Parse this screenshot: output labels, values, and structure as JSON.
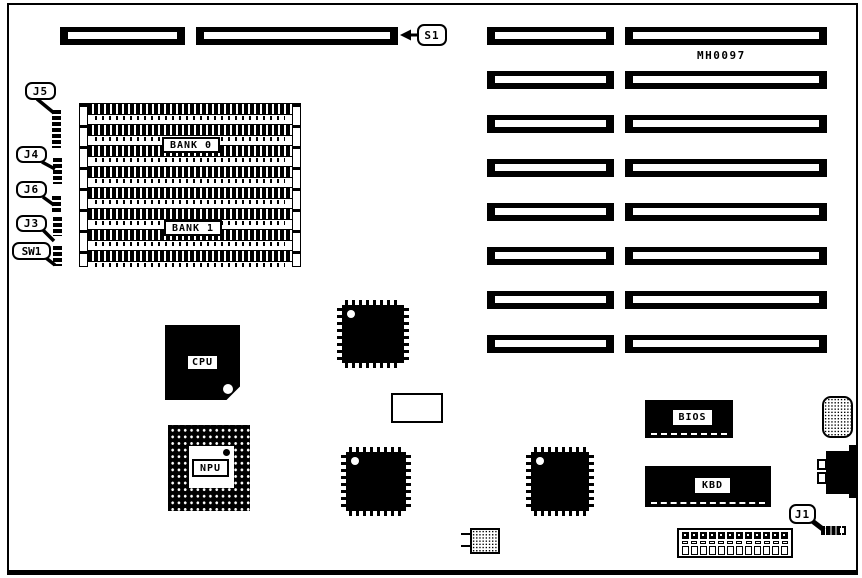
{
  "board": {
    "part_number": "MH0097"
  },
  "callouts": {
    "s1": "S1",
    "j5": "J5",
    "j4": "J4",
    "j6": "J6",
    "j3": "J3",
    "sw1": "SW1",
    "j1": "J1"
  },
  "chips": {
    "cpu": "CPU",
    "npu": "NPU",
    "bios": "BIOS",
    "kbd": "KBD"
  },
  "memory": {
    "bank0_label": "BANK 0",
    "bank1_label": "BANK 1",
    "simm_rows": 8
  },
  "expansion": {
    "rows": 8,
    "columns": 2
  },
  "power": {
    "pins": 12
  }
}
